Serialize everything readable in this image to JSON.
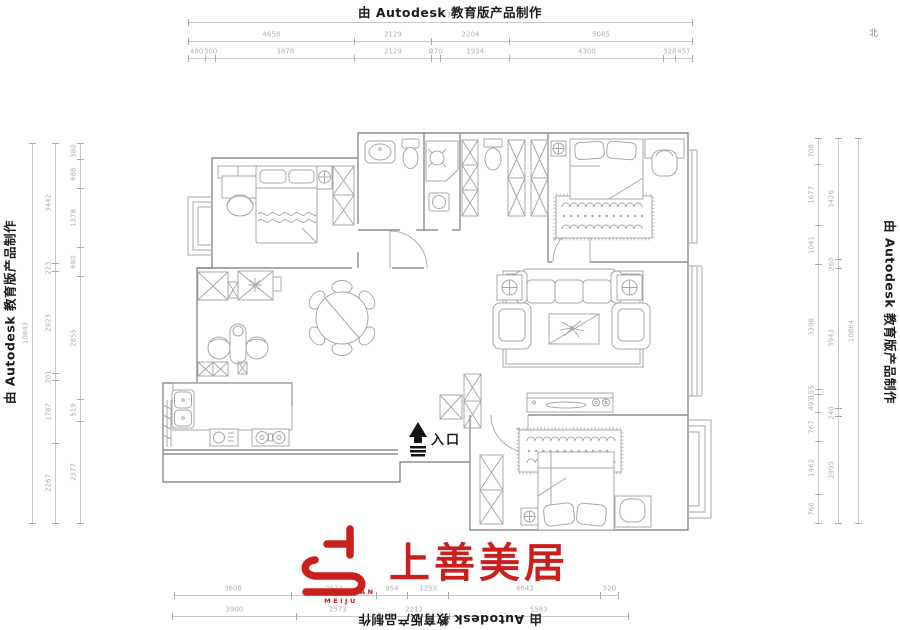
{
  "watermarks": {
    "autodesk": "由 Autodesk 教育版产品制作"
  },
  "compass": {
    "north": "北"
  },
  "plan": {
    "entrance": "入口"
  },
  "logo": {
    "cn": "上善美居",
    "en_top": "SHANGSHAN",
    "en_bottom": "MEIJU",
    "red": "#c9201d"
  },
  "dims": {
    "top_total": [
      "14767"
    ],
    "top_mid": [
      "4658",
      "2129",
      "2204",
      "5085"
    ],
    "top_inner": [
      "480",
      "300",
      "3878",
      "2129",
      "0",
      "270",
      "1934",
      "4300",
      "328",
      "457"
    ],
    "bottom_inner": [
      "3600",
      "2573",
      "954",
      "1259",
      "4642",
      "520"
    ],
    "bottom_outer": [
      "3900",
      "2573",
      "2212",
      "5583"
    ],
    "left_total": [
      "10843"
    ],
    "left_mid": [
      "3442",
      "223",
      "2923",
      "201",
      "1787",
      "2267"
    ],
    "left_inner": [
      "380",
      "686",
      "1378",
      "680",
      "2855",
      "519",
      "2377"
    ],
    "right_inner": [
      "708",
      "1677",
      "1041",
      "3398",
      "155",
      "493",
      "767",
      "1462",
      "766"
    ],
    "right_mid": [
      "3426",
      "260",
      "3943",
      "240",
      "2995"
    ],
    "right_total": [
      "10864"
    ]
  }
}
